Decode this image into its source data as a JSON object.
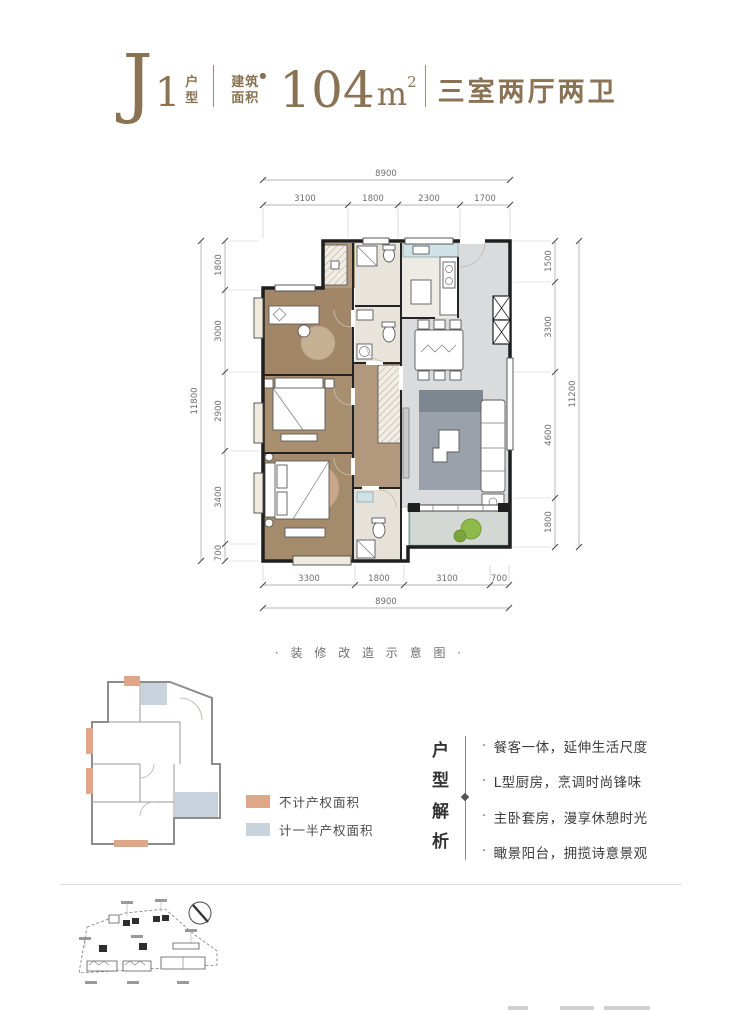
{
  "header": {
    "plan_letter": "J",
    "plan_number": "1",
    "hu": "户",
    "xing": "型",
    "jian": "建筑",
    "mian": "面积",
    "dot": "●",
    "area": "104",
    "unit": "m",
    "sup": "2",
    "rooms": "三室两厅两卫"
  },
  "plan": {
    "caption": "· 装 修 改 造 示 意 图 ·",
    "dims": {
      "top_total": "8900",
      "top": [
        "3100",
        "1800",
        "2300",
        "1700"
      ],
      "left_total": "11800",
      "left": [
        "1800",
        "3000",
        "2900",
        "3400",
        "700"
      ],
      "right_total": "11200",
      "right": [
        "1500",
        "3300",
        "4600",
        "1800"
      ],
      "bottom_total": "8900",
      "bottom": [
        "3300",
        "1800",
        "3100",
        "700"
      ]
    }
  },
  "legend": {
    "items": [
      {
        "label": "不计产权面积",
        "color": "#dfa78a"
      },
      {
        "label": "计一半产权面积",
        "color": "#c9d3de"
      }
    ]
  },
  "analysis": {
    "title_chars": [
      "户",
      "型",
      "解",
      "析"
    ],
    "bullet": "·",
    "items": [
      "餐客一体，延伸生活尺度",
      "L型厨房，烹调时尚锋味",
      "主卧套房，漫享休憩时光",
      "瞰景阳台，拥揽诗意景观"
    ]
  },
  "colors": {
    "title_brown": "#8a7254",
    "wall": "#1f1f1f",
    "wood_floor": "#a68d6e",
    "marble_floor": "#d9dbdc",
    "legend_orange": "#dfa78a",
    "legend_blue": "#c9d3de",
    "plant_green": "#8cbb4a"
  }
}
